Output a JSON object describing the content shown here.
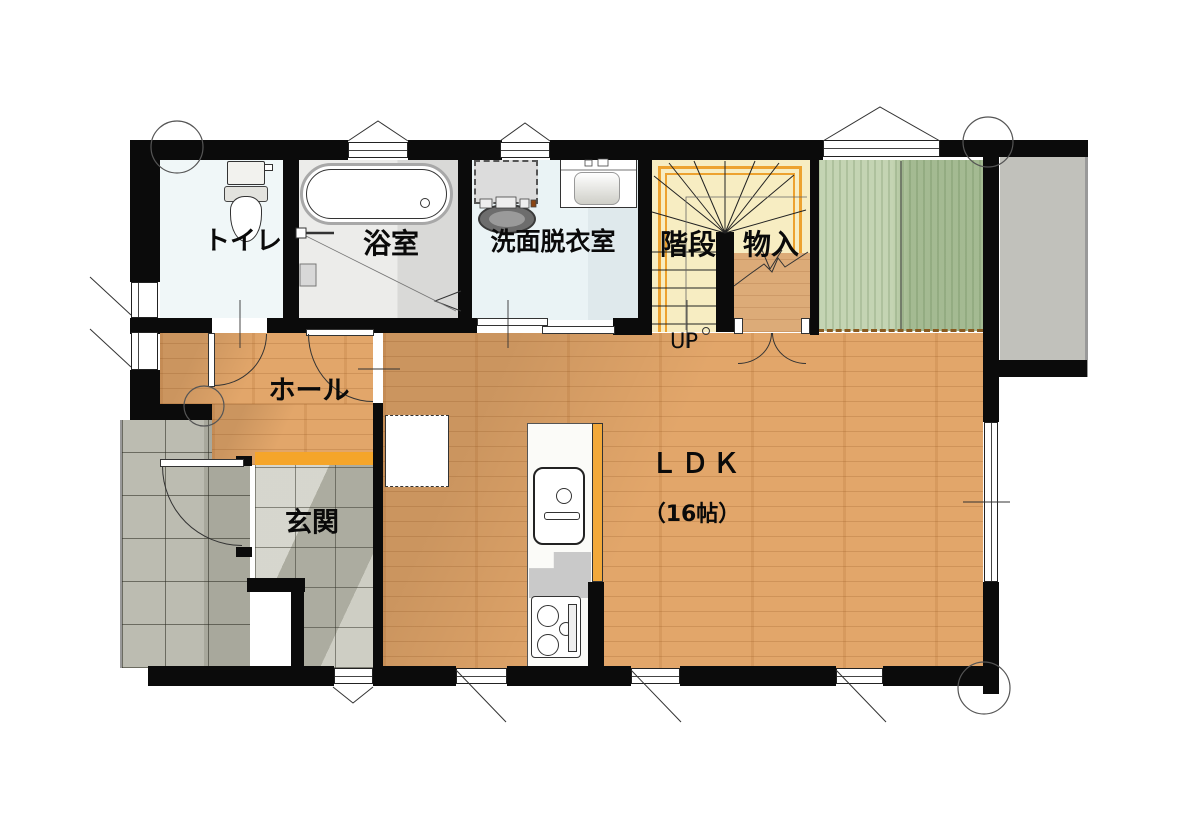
{
  "title": "1F floor plan",
  "rooms": {
    "toilet": {
      "label": "トイレ"
    },
    "bathroom": {
      "label": "浴室"
    },
    "washroom": {
      "label": "洗面脱衣室"
    },
    "stairs": {
      "label": "階段",
      "direction_label": "UP"
    },
    "storage": {
      "label": "物入"
    },
    "hall": {
      "label": "ホール"
    },
    "entrance": {
      "label": "玄関"
    },
    "ldk": {
      "label": "ＬＤＫ",
      "size_label": "（16帖）"
    }
  },
  "colors": {
    "wall": "#0b0b0b",
    "wood_floor": "#e2a66a",
    "stairs_floor": "#f7edc2",
    "stairs_frame": "#eda22f",
    "green_closet": "#b7cba2",
    "entrance_step_accent": "#f5a52a",
    "kitchen_counter_accent": "#f2a93b",
    "porch_tile": "#b3b3a6",
    "entrance_tile": "#c9c9bd",
    "terrace": "#c1c1bb",
    "toilet_floor": "#f0f7f8",
    "washroom_floor": "#eaf3f5",
    "bathroom_floor": "#ececea"
  }
}
